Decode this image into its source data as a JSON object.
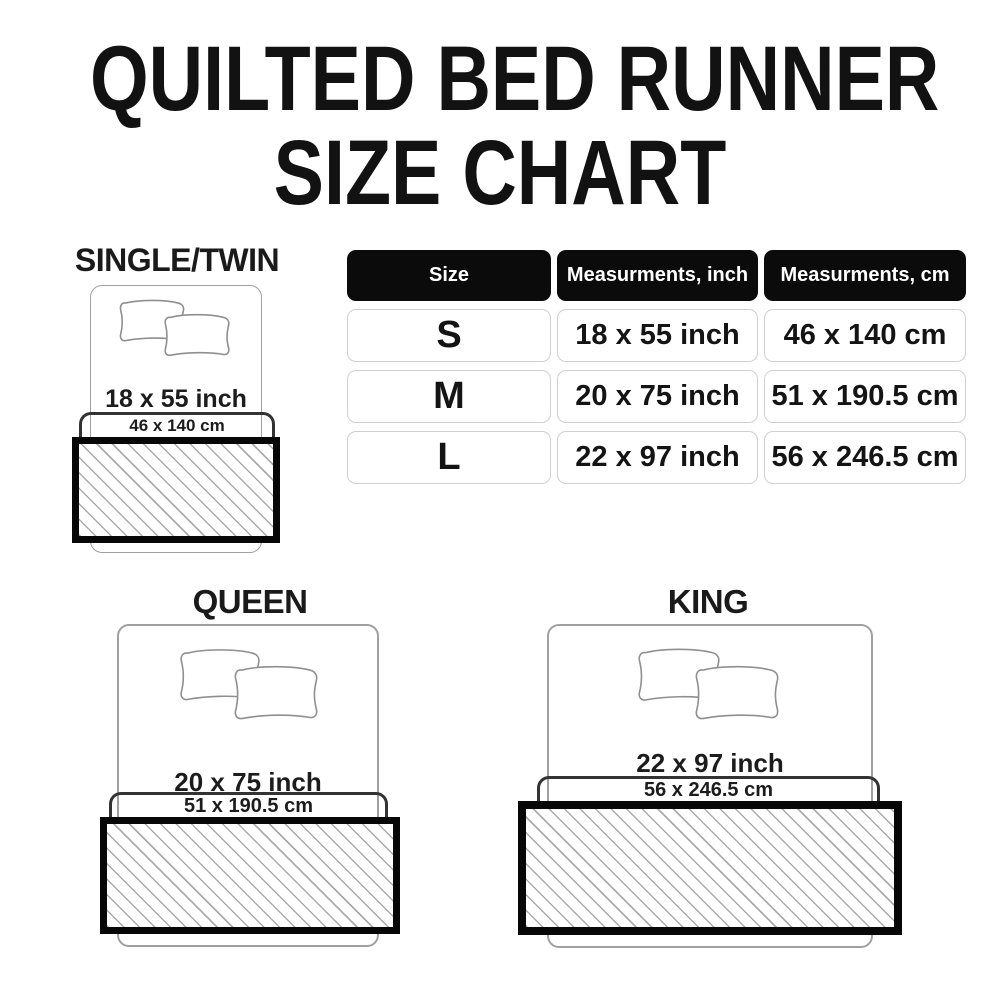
{
  "title": {
    "line1": "QUILTED BED RUNNER",
    "line2": "SIZE CHART"
  },
  "table": {
    "headers": [
      "Size",
      "Measurments, inch",
      "Measurments, cm"
    ],
    "rows": [
      {
        "size": "S",
        "inch": "18 x 55 inch",
        "cm": "46 x 140 cm"
      },
      {
        "size": "M",
        "inch": "20 x 75 inch",
        "cm": "51 x 190.5 cm"
      },
      {
        "size": "L",
        "inch": "22 x 97 inch",
        "cm": "56 x 246.5 cm"
      }
    ]
  },
  "sections": {
    "single": {
      "label": "SINGLE/TWIN",
      "inch": "18 x 55 inch",
      "cm": "46 x 140 cm"
    },
    "queen": {
      "label": "QUEEN",
      "inch": "20 x 75 inch",
      "cm": "51 x 190.5 cm"
    },
    "king": {
      "label": "KING",
      "inch": "22 x 97 inch",
      "cm": "56 x 246.5 cm"
    }
  },
  "colors": {
    "background": "#ffffff",
    "title_text": "#121212",
    "body_text": "#1c1c1c",
    "table_header_bg": "#0b0b0b",
    "table_header_text": "#ffffff",
    "table_cell_border": "#d0d0d0",
    "bed_outline": "#a0a0a0",
    "pillow_outline": "#8f8f8f",
    "bracket_line": "#333333",
    "runner_border": "#070707",
    "hatch_line": "#ababab"
  }
}
